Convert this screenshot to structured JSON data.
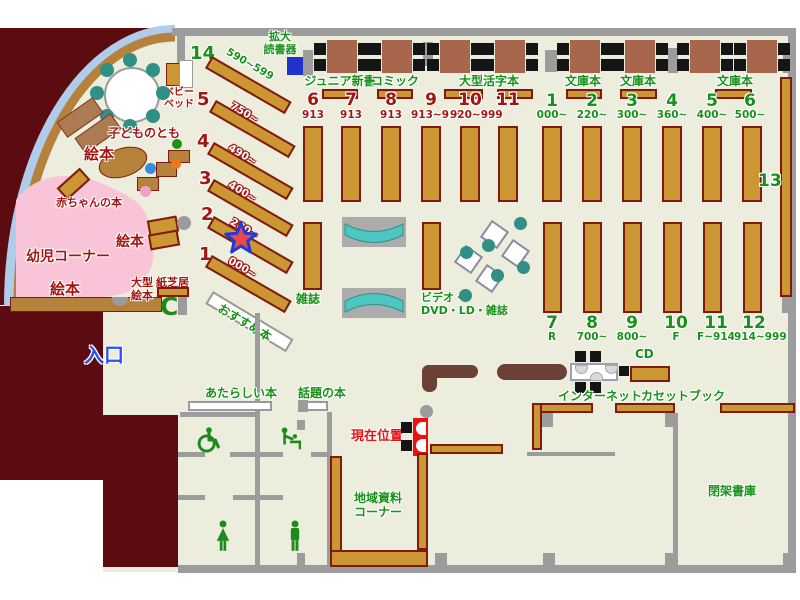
{
  "colors": {
    "floor": "#EDEDDD",
    "wall_gray": "#9C9C9C",
    "shelf_brown": "#CC9633",
    "maroon": "#5C0B10",
    "green_text": "#179117",
    "dark_red_text": "#A21511",
    "entrance_blue": "#2952F0",
    "teal": "#2F9186",
    "pink_area": "#F9C4D7"
  },
  "top_row": {
    "magnifier_label": "拡大\n読書器",
    "sections": [
      {
        "label": "ジュニア新書"
      },
      {
        "label": "コミック"
      },
      {
        "label": "大型活字本"
      },
      {
        "label": "文庫本"
      },
      {
        "label": "文庫本"
      },
      {
        "label": "文庫本"
      }
    ]
  },
  "stacks": {
    "red": [
      {
        "num": "6",
        "range": "913"
      },
      {
        "num": "7",
        "range": "913"
      },
      {
        "num": "8",
        "range": "913"
      },
      {
        "num": "9",
        "range": "913~919"
      },
      {
        "num": "10",
        "range": "920~999"
      },
      {
        "num": "11",
        "range": ""
      }
    ],
    "green_top": [
      {
        "num": "1",
        "range": "000~"
      },
      {
        "num": "2",
        "range": "220~"
      },
      {
        "num": "3",
        "range": "300~"
      },
      {
        "num": "4",
        "range": "360~"
      },
      {
        "num": "5",
        "range": "400~"
      },
      {
        "num": "6",
        "range": "500~"
      }
    ],
    "green_bottom": [
      {
        "num": "7",
        "range": "R"
      },
      {
        "num": "8",
        "range": "700~"
      },
      {
        "num": "9",
        "range": "800~"
      },
      {
        "num": "10",
        "range": "F"
      },
      {
        "num": "11",
        "range": "F~914"
      },
      {
        "num": "12",
        "range": "914~999"
      }
    ],
    "wall_shelf": {
      "num": "13"
    }
  },
  "kids": {
    "shelves": [
      {
        "num": "14",
        "range": "590~599"
      },
      {
        "num": "5",
        "range": "750~"
      },
      {
        "num": "4",
        "range": "490~"
      },
      {
        "num": "3",
        "range": "400~"
      },
      {
        "num": "2",
        "range": "280~"
      },
      {
        "num": "1",
        "range": "000~"
      }
    ],
    "baby_bed": "ベビー\nベッド",
    "kodomonotomo": "子どものとも",
    "ehon_top": "絵本",
    "ehon_mid": "絵本",
    "ehon_bottom": "絵本",
    "akachan_books": "赤ちゃんの本",
    "toddler_corner": "幼児コーナー",
    "large_picture_books": "大型\n絵本",
    "kamishibai": "紙芝居"
  },
  "center": {
    "magazines": "雑誌",
    "video": "ビデオ・\nDVD・LD・雑誌",
    "recommended": "おすすめ本"
  },
  "services": {
    "cd": "CD",
    "internet": "インターネット",
    "cassette": "カセットブック"
  },
  "south": {
    "entrance": "入口",
    "new_books": "あたらしい本",
    "topical_books": "話題の本",
    "current_location": "現在位置",
    "local_materials": "地域資料\nコーナー",
    "closed_stacks": "閉架書庫"
  }
}
